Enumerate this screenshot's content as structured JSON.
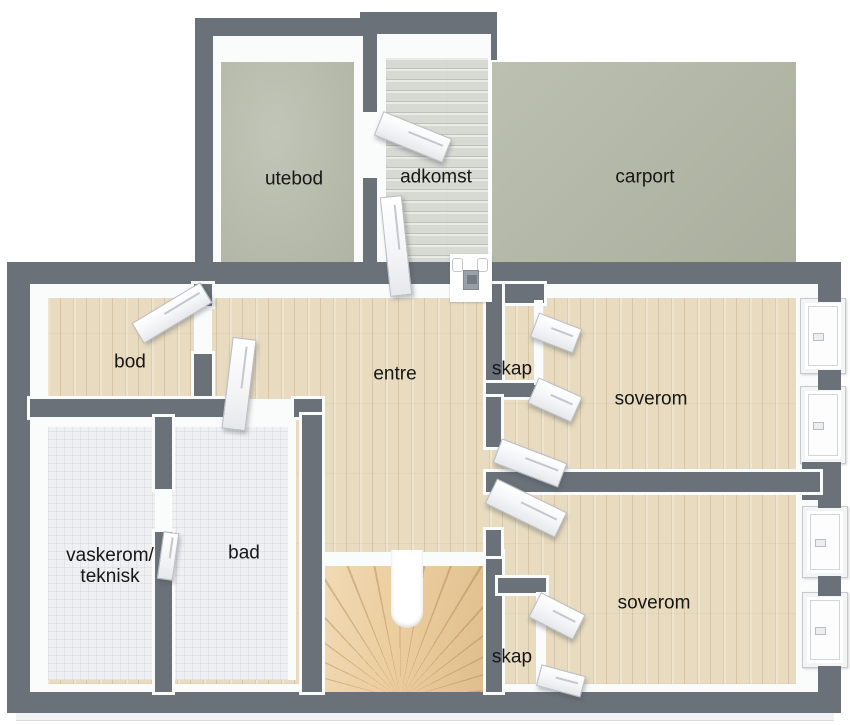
{
  "image_type": "3d-floor-plan-top-view",
  "rooms": {
    "utebod": {
      "label": "utebod",
      "floor": "concrete"
    },
    "adkomst": {
      "label": "adkomst",
      "floor": "whitewashed-planks"
    },
    "carport": {
      "label": "carport",
      "floor": "concrete-slab"
    },
    "bod": {
      "label": "bod",
      "floor": "wood"
    },
    "entre": {
      "label": "entre",
      "floor": "wood"
    },
    "skap_upper": {
      "label": "skap",
      "floor": "wood"
    },
    "soverom_upper": {
      "label": "soverom",
      "floor": "wood"
    },
    "vaskerom": {
      "label_line1": "vaskerom/",
      "label_line2": "teknisk",
      "floor": "tile"
    },
    "bad": {
      "label": "bad",
      "floor": "tile"
    },
    "soverom_lower": {
      "label": "soverom",
      "floor": "wood"
    },
    "skap_lower": {
      "label": "skap",
      "floor": "wood"
    }
  },
  "features": {
    "stairs": "u-shaped winder stair",
    "windows_on_right_wall": 4,
    "open_door_panels": 11,
    "entry_door_fixture": "front entrance between adkomst and entre"
  },
  "colors": {
    "wall": "#6b7179",
    "wall-inner": "#fafbfb",
    "wood": "#e8dbbf",
    "tile": "#eef0f2",
    "concrete": "#b9bdad",
    "carport": "#b5b9a7",
    "plank": "#d7dad2",
    "stair": "#ecce9e",
    "label": "#161616",
    "door": "#f4f5f7",
    "door-edge": "#b9bec5"
  }
}
